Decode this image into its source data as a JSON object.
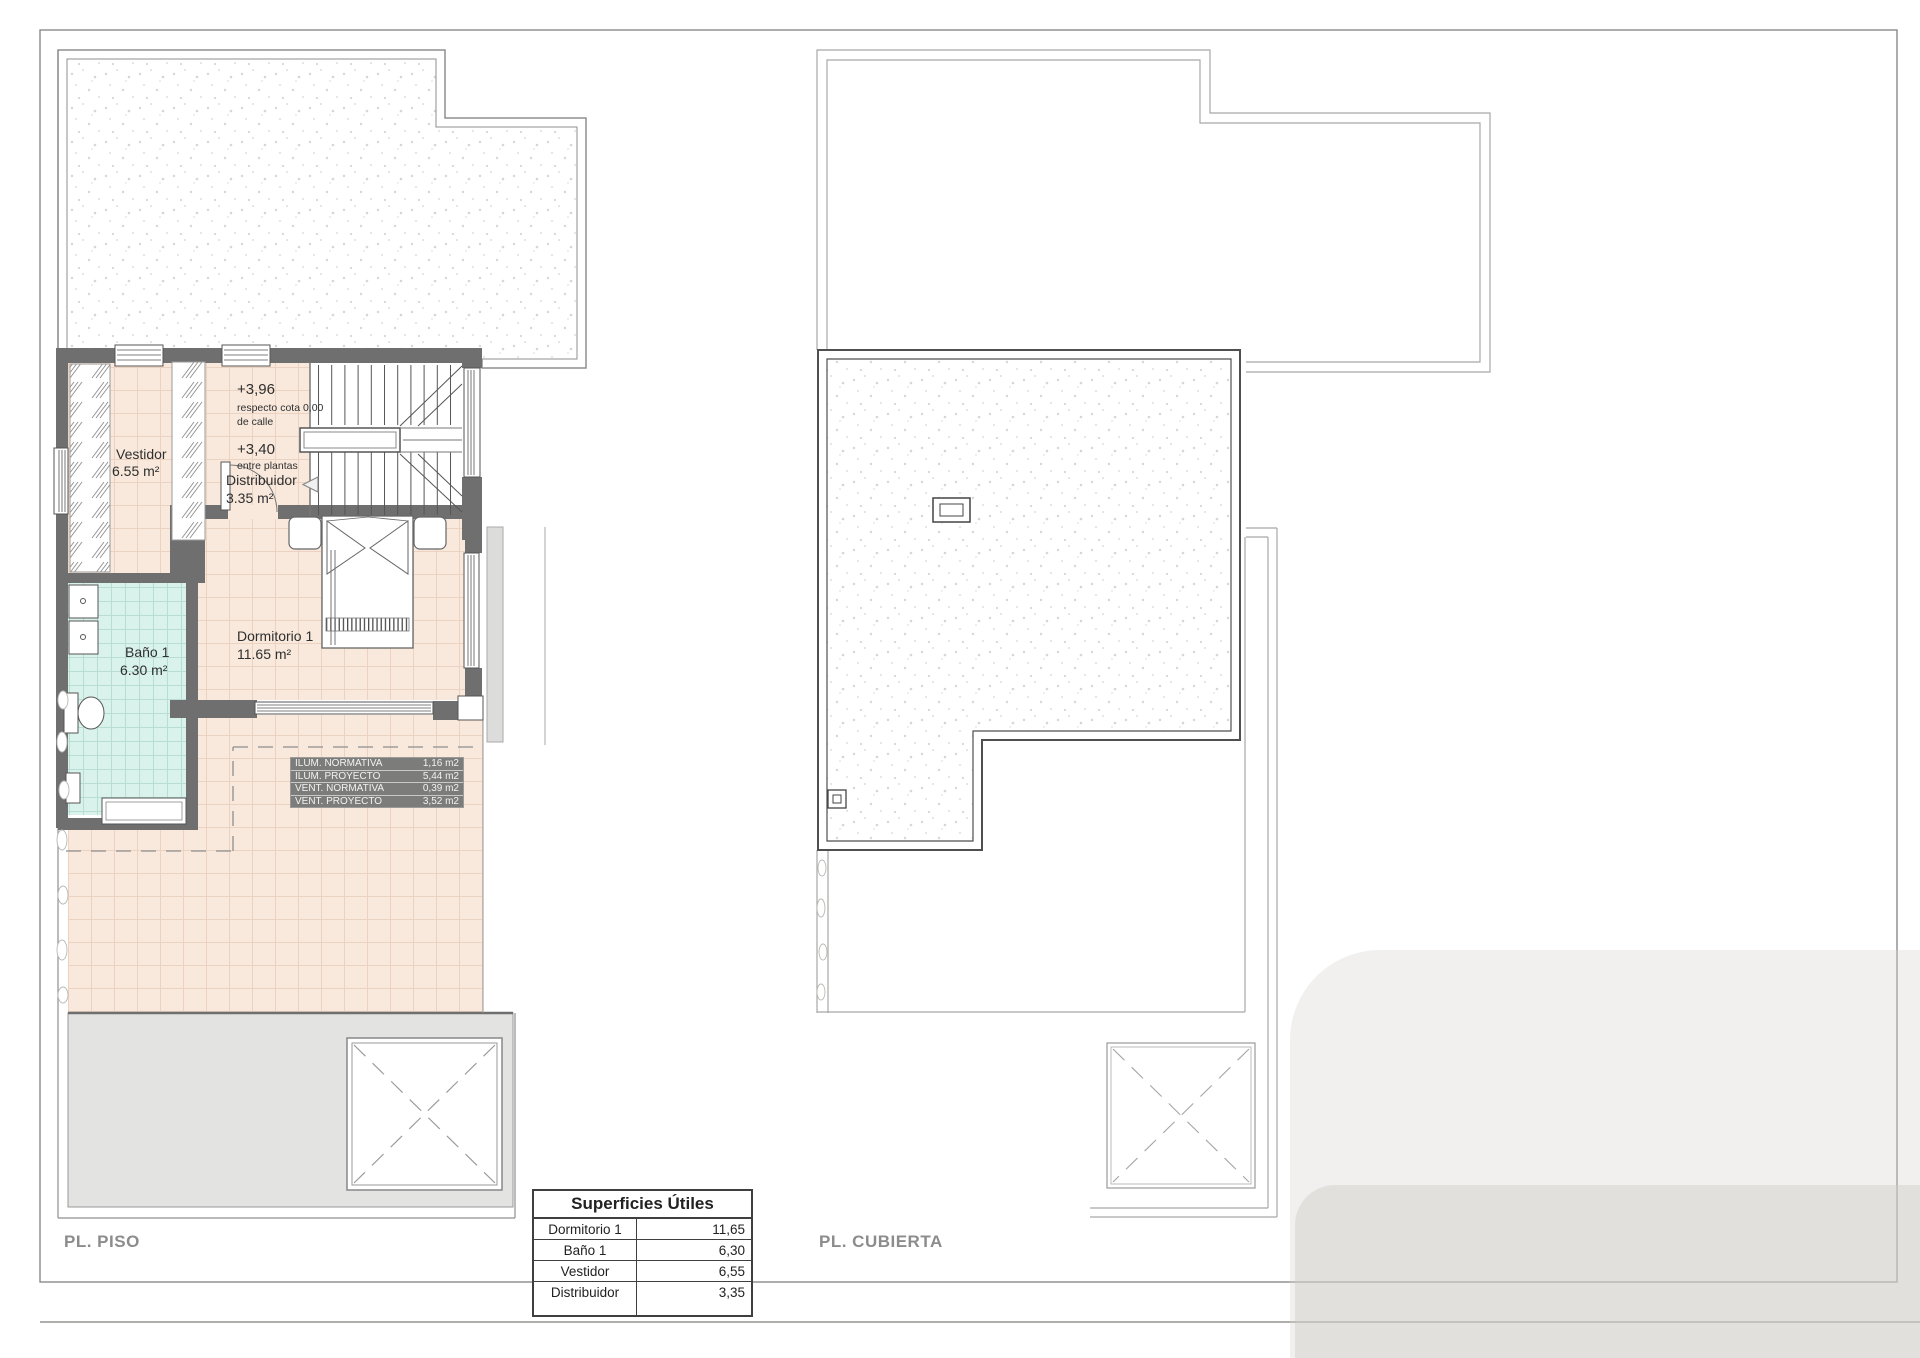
{
  "plans": {
    "piso": {
      "name_label": "PL. PISO",
      "rooms": {
        "vestidor": {
          "name": "Vestidor",
          "area": "6.55 m²"
        },
        "distribuidor": {
          "name": "Distribuidor",
          "area": "3.35 m²"
        },
        "dormitorio": {
          "name": "Dormitorio 1",
          "area": "11.65 m²"
        },
        "bano": {
          "name": "Baño 1",
          "area": "6.30 m²"
        }
      },
      "levels": {
        "upper": {
          "value": "+3,96",
          "note1": "respecto cota 0,00",
          "note2": "de calle"
        },
        "mid": {
          "value": "+3,40",
          "note1": "entre plantas"
        }
      },
      "vent_table": {
        "rows": [
          {
            "label": "ILUM. NORMATIVA",
            "value": "1,16 m2"
          },
          {
            "label": "ILUM. PROYECTO",
            "value": "5,44 m2"
          },
          {
            "label": "VENT. NORMATIVA",
            "value": "0,39 m2"
          },
          {
            "label": "VENT. PROYECTO",
            "value": "3,52 m2"
          }
        ]
      }
    },
    "cubierta": {
      "name_label": "PL. CUBIERTA"
    }
  },
  "areas_table": {
    "title": "Superficies Útiles",
    "rows": [
      {
        "label": "Dormitorio 1",
        "value": "11,65"
      },
      {
        "label": "Baño 1",
        "value": "6,30"
      },
      {
        "label": "Vestidor",
        "value": "6,55"
      },
      {
        "label": "Distribuidor",
        "value": "3,35"
      }
    ]
  },
  "colors": {
    "wall": "#6f6f6f",
    "floor_tile": "#f9e9dc",
    "bath_tile": "#daf2ec",
    "vent_table_bg": "#7c7c7a",
    "label_gray": "#8c8c8c",
    "line_gray": "#a0a0a0",
    "ink": "#2f2f2f"
  }
}
